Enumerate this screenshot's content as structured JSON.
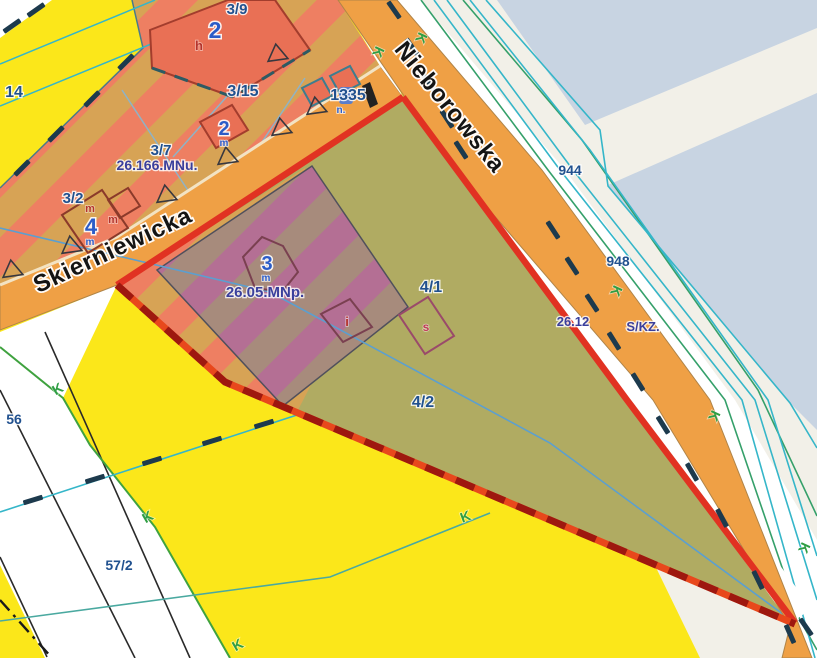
{
  "map": {
    "title": "zoning-map-view",
    "streets": [
      {
        "name": "Skierniewicka",
        "x": 116,
        "y": 257,
        "rot": -25,
        "size": 24
      },
      {
        "name": "Nieborowska",
        "x": 444,
        "y": 112,
        "rot": 51,
        "size": 24
      }
    ],
    "labels": [
      {
        "text": "14",
        "x": 14,
        "y": 97,
        "cls": "parcel",
        "size": 16
      },
      {
        "text": "3/9",
        "x": 237,
        "y": 14,
        "cls": "parcel",
        "size": 15
      },
      {
        "text": "2",
        "x": 215,
        "y": 38,
        "cls": "bignum",
        "size": 23
      },
      {
        "text": "h",
        "x": 199,
        "y": 50,
        "cls": "red",
        "size": 13
      },
      {
        "text": "3/15",
        "x": 243,
        "y": 96,
        "cls": "parcel",
        "size": 16
      },
      {
        "text": "1335",
        "x": 348,
        "y": 100,
        "cls": "parcel",
        "size": 16
      },
      {
        "text": "n.",
        "x": 341,
        "y": 113,
        "cls": "smallblue",
        "size": 10
      },
      {
        "text": "2",
        "x": 224,
        "y": 135,
        "cls": "bignum",
        "size": 20
      },
      {
        "text": "m",
        "x": 224,
        "y": 146,
        "cls": "smallblue",
        "size": 10
      },
      {
        "text": "3/7",
        "x": 161,
        "y": 155,
        "cls": "parcel",
        "size": 15
      },
      {
        "text": "26.166.MNu.",
        "x": 157,
        "y": 170,
        "cls": "zone",
        "size": 14
      },
      {
        "text": "3/2",
        "x": 73,
        "y": 203,
        "cls": "parcel",
        "size": 15
      },
      {
        "text": "m",
        "x": 90,
        "y": 212,
        "cls": "red",
        "size": 11
      },
      {
        "text": "m",
        "x": 113,
        "y": 223,
        "cls": "red",
        "size": 11
      },
      {
        "text": "4",
        "x": 91,
        "y": 234,
        "cls": "bignum",
        "size": 22
      },
      {
        "text": "m",
        "x": 90,
        "y": 245,
        "cls": "smallblue",
        "size": 10
      },
      {
        "text": "3",
        "x": 267,
        "y": 270,
        "cls": "bignum",
        "size": 20
      },
      {
        "text": "m",
        "x": 266,
        "y": 281,
        "cls": "smallblue",
        "size": 10
      },
      {
        "text": "26.05.MNp.",
        "x": 265,
        "y": 297,
        "cls": "zone",
        "size": 15
      },
      {
        "text": "i",
        "x": 347,
        "y": 326,
        "cls": "red",
        "size": 13
      },
      {
        "text": "4/1",
        "x": 431,
        "y": 292,
        "cls": "parcel",
        "size": 16
      },
      {
        "text": "s",
        "x": 426,
        "y": 331,
        "cls": "crimson",
        "size": 12
      },
      {
        "text": "4/2",
        "x": 423,
        "y": 407,
        "cls": "parcel",
        "size": 16
      },
      {
        "text": "56",
        "x": 14,
        "y": 424,
        "cls": "parcel",
        "size": 14
      },
      {
        "text": "57/2",
        "x": 119,
        "y": 570,
        "cls": "parcel",
        "size": 14
      },
      {
        "text": "944",
        "x": 570,
        "y": 175,
        "cls": "parcel",
        "size": 14
      },
      {
        "text": "948",
        "x": 618,
        "y": 266,
        "cls": "parcel",
        "size": 14
      },
      {
        "text": "26.12",
        "x": 573,
        "y": 326,
        "cls": "zone",
        "size": 13
      },
      {
        "text": "S/KZ.",
        "x": 643,
        "y": 331,
        "cls": "zone",
        "size": 13
      }
    ],
    "k_markers": [
      [
        374,
        50,
        115
      ],
      [
        417,
        36,
        115
      ],
      [
        612,
        289,
        115
      ],
      [
        710,
        414,
        115
      ],
      [
        800,
        546,
        115
      ],
      [
        60,
        393,
        -30
      ],
      [
        150,
        521,
        -30
      ],
      [
        240,
        649,
        -30
      ],
      [
        467,
        521,
        -20
      ]
    ],
    "fence_dashes": [
      [
        394,
        10,
        55
      ],
      [
        412,
        47,
        55
      ],
      [
        429,
        83,
        55
      ],
      [
        447,
        119,
        57
      ],
      [
        461,
        150,
        57
      ],
      [
        553,
        230,
        57
      ],
      [
        572,
        266,
        57
      ],
      [
        592,
        303,
        57
      ],
      [
        614,
        341,
        58
      ],
      [
        638,
        382,
        58
      ],
      [
        663,
        425,
        58
      ],
      [
        692,
        472,
        60
      ],
      [
        722,
        518,
        62
      ],
      [
        758,
        580,
        64
      ],
      [
        790,
        634,
        66
      ],
      [
        806,
        627,
        55
      ],
      [
        33,
        500,
        -17
      ],
      [
        95,
        479,
        -17
      ],
      [
        152,
        461,
        -17
      ],
      [
        212,
        441,
        -17
      ],
      [
        264,
        424,
        -17
      ],
      [
        12,
        26,
        -35
      ],
      [
        36,
        10,
        -35
      ],
      [
        22,
        168,
        -45
      ],
      [
        56,
        134,
        -45
      ],
      [
        92,
        99,
        -45
      ],
      [
        126,
        62,
        -45
      ]
    ],
    "survey_triangles": [
      [
        277,
        53
      ],
      [
        316,
        106
      ],
      [
        281,
        127
      ],
      [
        227,
        156
      ],
      [
        166,
        194
      ],
      [
        71,
        245
      ],
      [
        12,
        269
      ]
    ],
    "palette": {
      "yellow": "#fbe71a",
      "stripe_salmon": "#ee7f62",
      "stripe_tan": "#d7a355",
      "stripe_mauve": "#b46f94",
      "stripe_taupe": "#a78b7c",
      "olive": "#b0ab62",
      "road_orange": "#efa045",
      "offwhite": "#f2f0e8",
      "bluegray": "#c8d4e2",
      "selection_red": "#e13222",
      "selection_dash_red": "#9e180f",
      "cyan_line": "#35b6c9",
      "teal_green_line": "#35a06a",
      "boundary_green": "#3fa23f",
      "navy_dash": "#1d3a4d",
      "label_blue": "#21518f",
      "zone_label_indigo": "#3a3f9c",
      "building_fill": "#e97055",
      "building_border": "#a33d2d"
    }
  }
}
